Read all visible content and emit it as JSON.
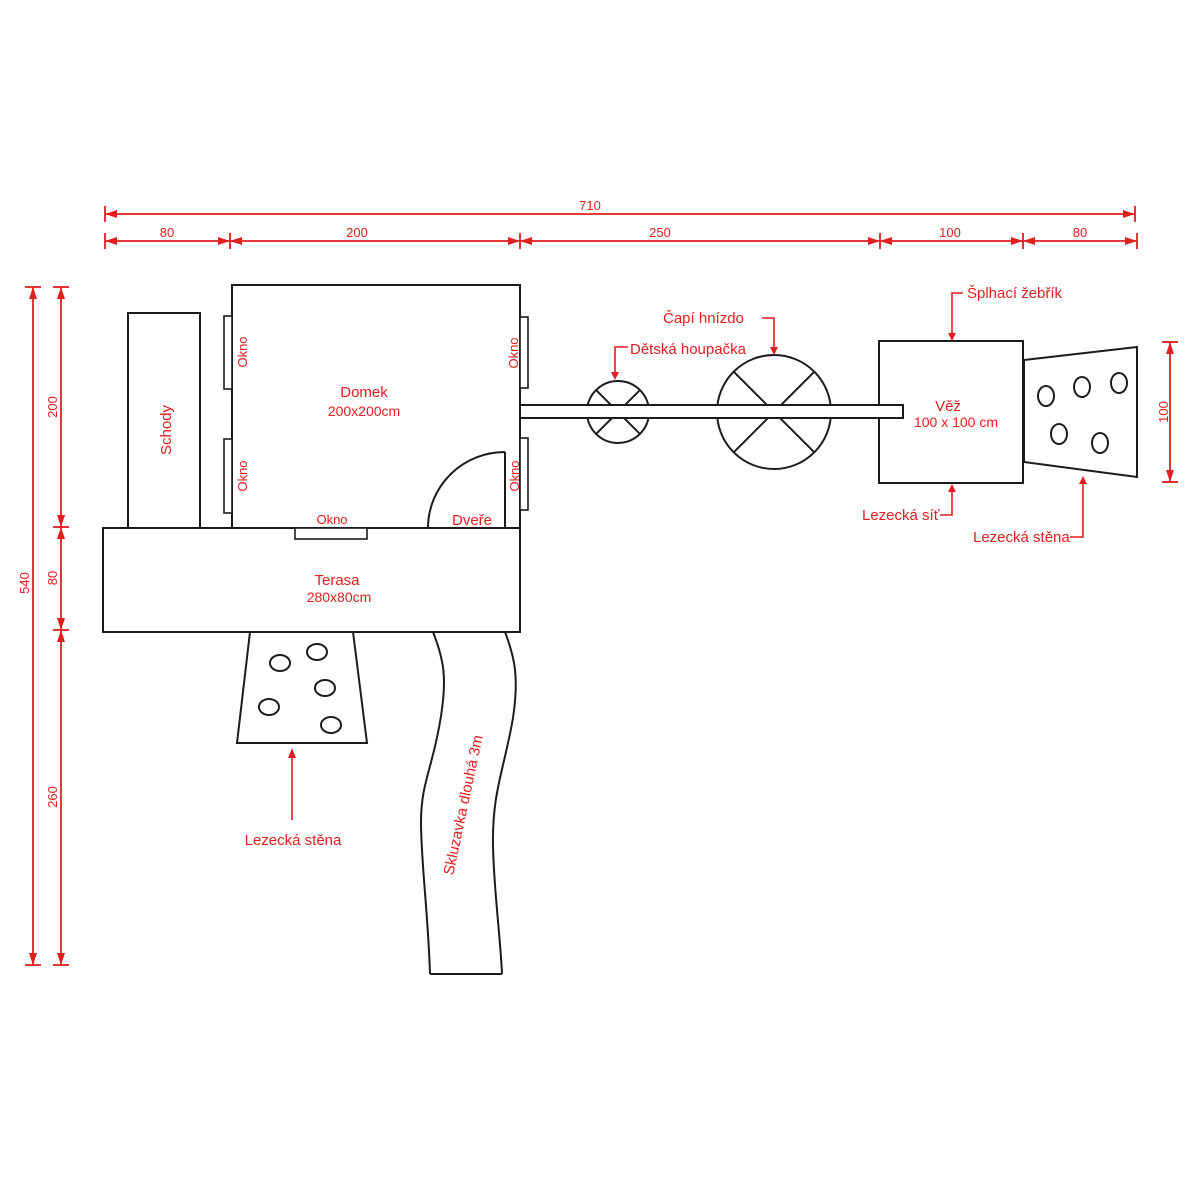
{
  "title": "Playground plan technical drawing",
  "colors": {
    "line": "#1c1c1c",
    "accent": "#e31e1e",
    "background": "#ffffff"
  },
  "dims": {
    "top_total": "710",
    "top_80a": "80",
    "top_200": "200",
    "top_250": "250",
    "top_100": "100",
    "top_80b": "80",
    "left_total": "540",
    "left_200": "200",
    "left_80": "80",
    "left_260": "260",
    "right_100": "100"
  },
  "labels": {
    "stairs": "Schody",
    "house_name": "Domek",
    "house_size": "200x200cm",
    "window": "Okno",
    "door": "Dveře",
    "terrace_name": "Terasa",
    "terrace_size": "280x80cm",
    "climbing_wall": "Lezecká stěna",
    "slide": "Skluzavka dlouhá 3m",
    "swing": "Dětská houpačka",
    "stork_nest": "Čapí hnízdo",
    "tower_name": "Věž",
    "tower_size": "100 x 100 cm",
    "climbing_ladder": "Šplhací žebřík",
    "climbing_net": "Lezecká síť"
  }
}
